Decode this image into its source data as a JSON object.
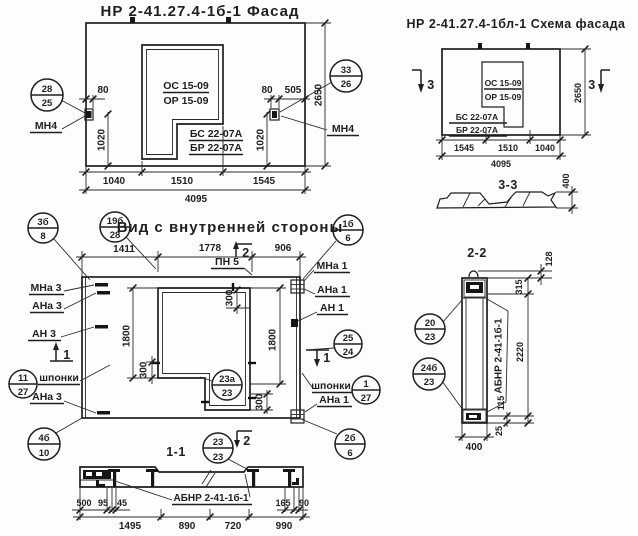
{
  "drawing": {
    "paper_color": "#fdfdfb",
    "ink_color": "#1f1f1f"
  },
  "facade": {
    "title": "НР 2-41.27.4-1б-1 Фасад",
    "opening_marks": {
      "top": "ОС 15-09",
      "bottom": "ОР 15-09"
    },
    "panel_marks": {
      "top": "БС 22-07А",
      "bottom": "БР 22-07А"
    },
    "callout_left": {
      "top": "28",
      "bottom": "25"
    },
    "callout_right": {
      "top": "33",
      "bottom": "26"
    },
    "anchor_label_left": "МН4",
    "anchor_label_right": "МН4",
    "dims": {
      "left_offset": "80",
      "right_offset": "80",
      "right_inset": "505",
      "left_height": "1020",
      "right_height": "1020",
      "total_height": "2650",
      "bottom_1": "1040",
      "bottom_2": "1510",
      "bottom_3": "1545",
      "total_width": "4095"
    }
  },
  "schema": {
    "title": "НР 2-41.27.4-1бл-1 Схема фасада",
    "opening_marks": {
      "top": "ОС 15-09",
      "bottom": "ОР 15-09"
    },
    "panel_marks": {
      "top": "БС 22-07А",
      "bottom": "БР 22-07А"
    },
    "section_marker": "3",
    "dims": {
      "total_height": "2650",
      "bottom_1": "1545",
      "bottom_2": "1510",
      "bottom_3": "1040",
      "total_width": "4095"
    }
  },
  "section33": {
    "label": "3-3",
    "thickness": "400"
  },
  "section22": {
    "label": "2-2",
    "panel_mark": "АБНР 2-41-1б-1",
    "callout_upper": {
      "top": "20",
      "bottom": "23"
    },
    "callout_lower": {
      "top": "24б",
      "bottom": "23"
    },
    "dims": {
      "loop": "128",
      "top": "315",
      "middle": "2220",
      "bottom": "115",
      "edge": "25",
      "width": "400"
    }
  },
  "innerview": {
    "title": "Вид с внутренней стороны",
    "callouts": {
      "c3b8": {
        "top": "3б",
        "bottom": "8"
      },
      "c19b28": {
        "top": "19б",
        "bottom": "28"
      },
      "c1b6": {
        "top": "1б",
        "bottom": "6"
      },
      "c1127": {
        "top": "11",
        "bottom": "27"
      },
      "c4b10": {
        "top": "4б",
        "bottom": "10"
      },
      "c2524": {
        "top": "25",
        "bottom": "24"
      },
      "c127": {
        "top": "1",
        "bottom": "27"
      },
      "c2b6": {
        "top": "2б",
        "bottom": "6"
      },
      "c23a23": {
        "top": "23а",
        "bottom": "23"
      }
    },
    "labels": {
      "pn5": "ПН 5",
      "mna3": "МНа 3",
      "ana3_top": "АНа 3",
      "an3": "АН 3",
      "shponki_left": "шпонки",
      "ana3_bottom": "АНа 3",
      "mna1": "МНа 1",
      "ana1_top": "АНа 1",
      "an1": "АН 1",
      "shponki_right": "шпонки",
      "ana1_bottom": "АНа 1"
    },
    "markers": {
      "sec1": "1",
      "sec2": "2"
    },
    "dims": {
      "top_1": "1411",
      "top_2": "1778",
      "top_3": "906",
      "left_height": "1800",
      "right_height": "1800",
      "step": "300"
    }
  },
  "section11": {
    "label": "1-1",
    "callout": {
      "top": "23",
      "bottom": "23"
    },
    "panel_mark": "АБНР 2-41-1б-1",
    "dims": {
      "d500": "500",
      "d95": "95",
      "d45": "45",
      "d165": "165",
      "d90": "90",
      "b1": "1495",
      "b2": "890",
      "b3": "720",
      "b4": "990"
    }
  }
}
